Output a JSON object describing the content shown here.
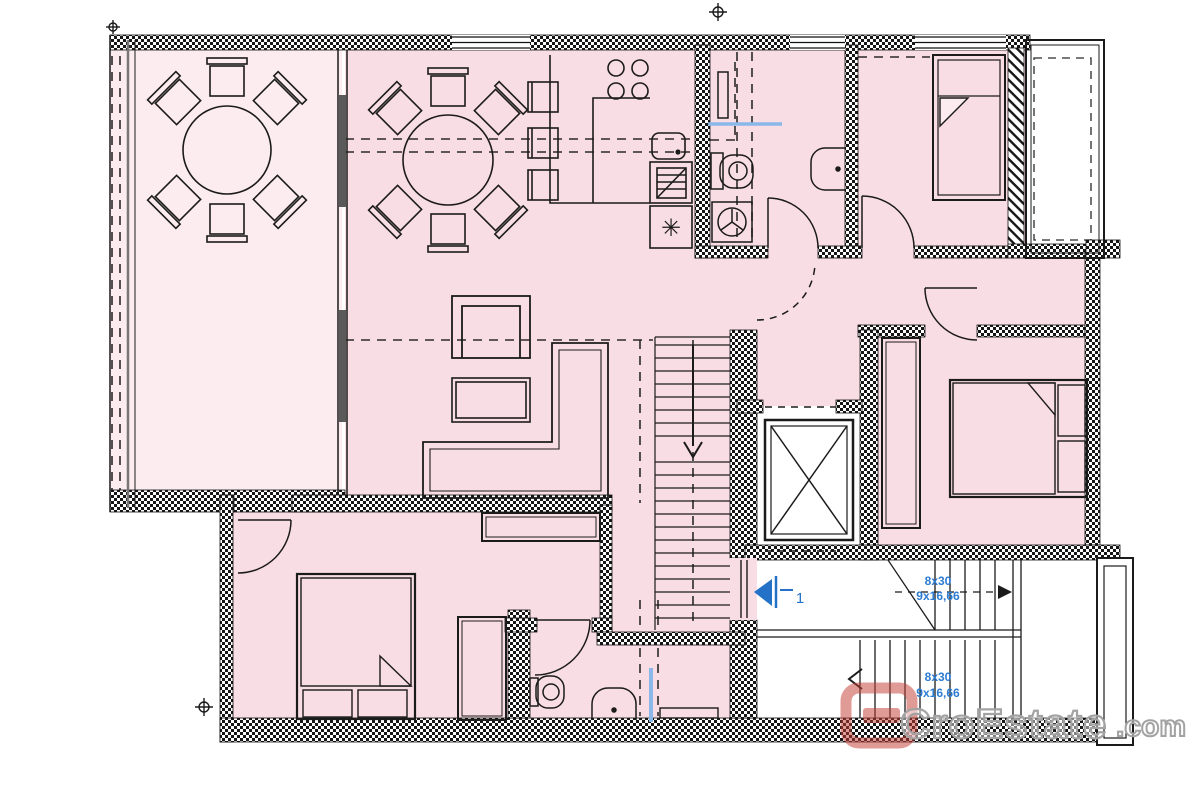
{
  "plan": {
    "type": "apartment-floor-plan",
    "stairs": {
      "upper": {
        "line1": "8x30",
        "line2": "9x16,66"
      },
      "lower": {
        "line1": "8x30",
        "line2": "9x16,66"
      }
    },
    "entrance": {
      "number": "1"
    },
    "symbols": {
      "freezer": "✳"
    },
    "colors": {
      "room_fill": "#f9dde4",
      "terrace_fill": "#fcecef",
      "line": "#1b1b1b",
      "annotation_blue": "#2d7cd2",
      "fixture_blue": "#8ab8e8",
      "watermark_red": "rgba(197,64,57,0.55)",
      "watermark_gray": "#a3a3a3"
    }
  },
  "watermark": {
    "brand": "CroEstate",
    "tld": ".com"
  }
}
